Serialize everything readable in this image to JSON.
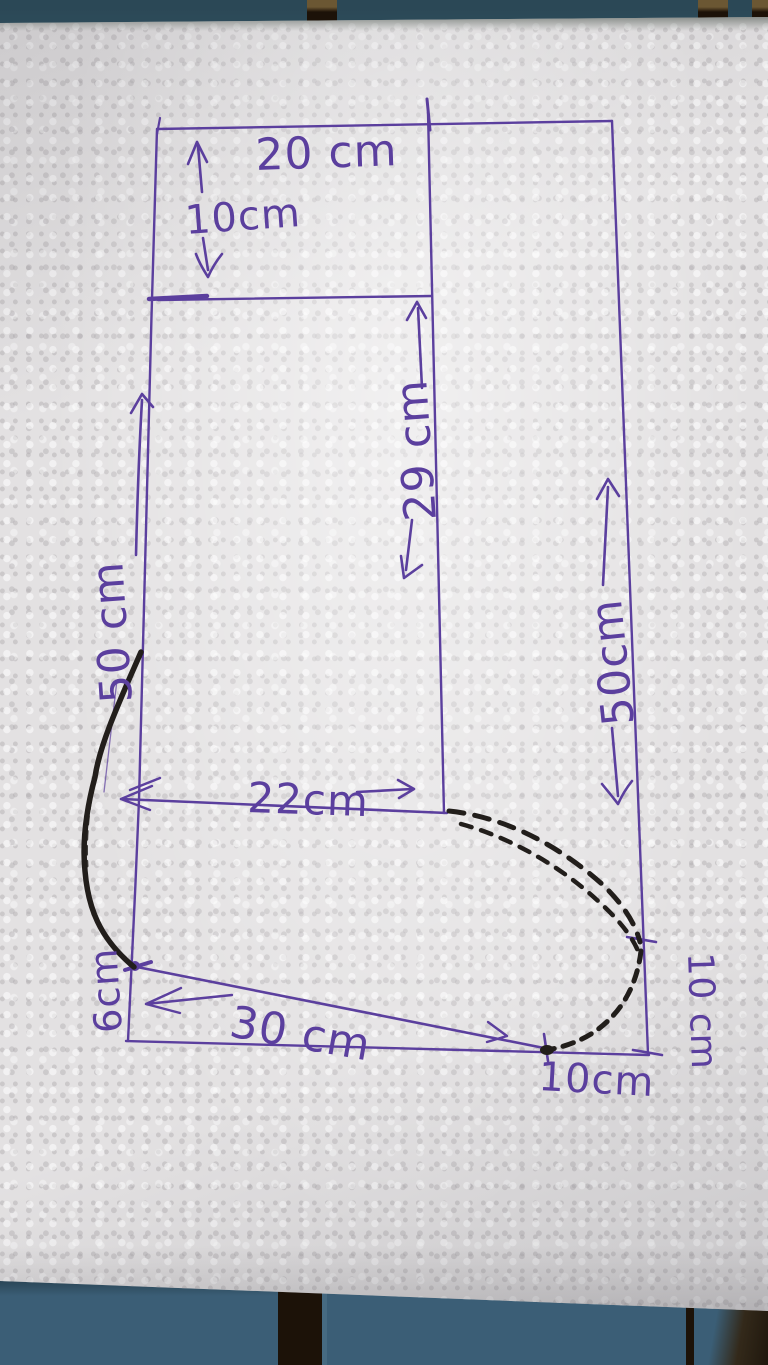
{
  "labels": {
    "top_width": "20 cm",
    "cuff_height": "10cm",
    "left_side": "50 cm",
    "inner_height": "29 cm",
    "mid_width": "22cm",
    "right_side": "50cm",
    "diagonal": "30 cm",
    "heel_height": "6cm",
    "toe_height": "10 cm",
    "toe_width": "10cm"
  },
  "colors": {
    "ink": "#5b3f9e",
    "marker": "#221e1b",
    "paper": "#e3e1e2",
    "bench_top": "#2f4e5d",
    "bench_bottom": "#3b5e76",
    "bench_gap": "#1c1208",
    "bench_wood": "#6b5733"
  }
}
